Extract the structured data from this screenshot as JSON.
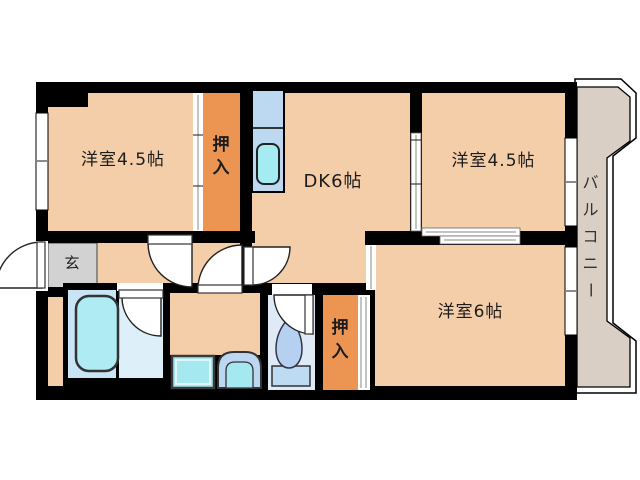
{
  "plan": {
    "type": "japanese-apartment-floor-plan",
    "rooms": {
      "room_nw": {
        "label": "洋室4.5帖"
      },
      "room_ne": {
        "label": "洋室4.5帖"
      },
      "room_se": {
        "label": "洋室6帖"
      },
      "dk": {
        "label": "DK6帖"
      },
      "closet_top": {
        "label": "押入",
        "chars": [
          "押",
          "入"
        ]
      },
      "closet_bottom": {
        "label": "押入",
        "chars": [
          "押",
          "入"
        ]
      },
      "genkan": {
        "label": "玄"
      },
      "balcony": {
        "label": "バルコニー",
        "chars": [
          "バ",
          "ル",
          "コ",
          "ニ",
          "ー"
        ]
      }
    },
    "fixtures": {
      "kitchen_counter": "kitchen-counter-with-sink",
      "bathtub": "bathtub",
      "washer_pan": "washing-machine-pan",
      "washbasin": "washbasin",
      "toilet": "toilet"
    },
    "colors": {
      "floor": "#F4CDA9",
      "closet": "#EC9452",
      "balcony_floor": "#D9CFC5",
      "genkan_floor": "#D2D2D2",
      "wall": "#000000",
      "bath_floor": "#C9E4F5",
      "bath_floor_right": "#DDF0FA",
      "tub": "#AEEBF3",
      "counter": "#BDD9F2",
      "sink": "#A5EBF2",
      "washer_pan": "#A5E8F0",
      "basin_outer": "#BCD7F2",
      "basin_inner": "#A5E8F0",
      "toilet_floor": "#DEEBF7",
      "toilet_bowl": "#B5D0F0",
      "toilet_tank": "#BDDCF4"
    }
  }
}
